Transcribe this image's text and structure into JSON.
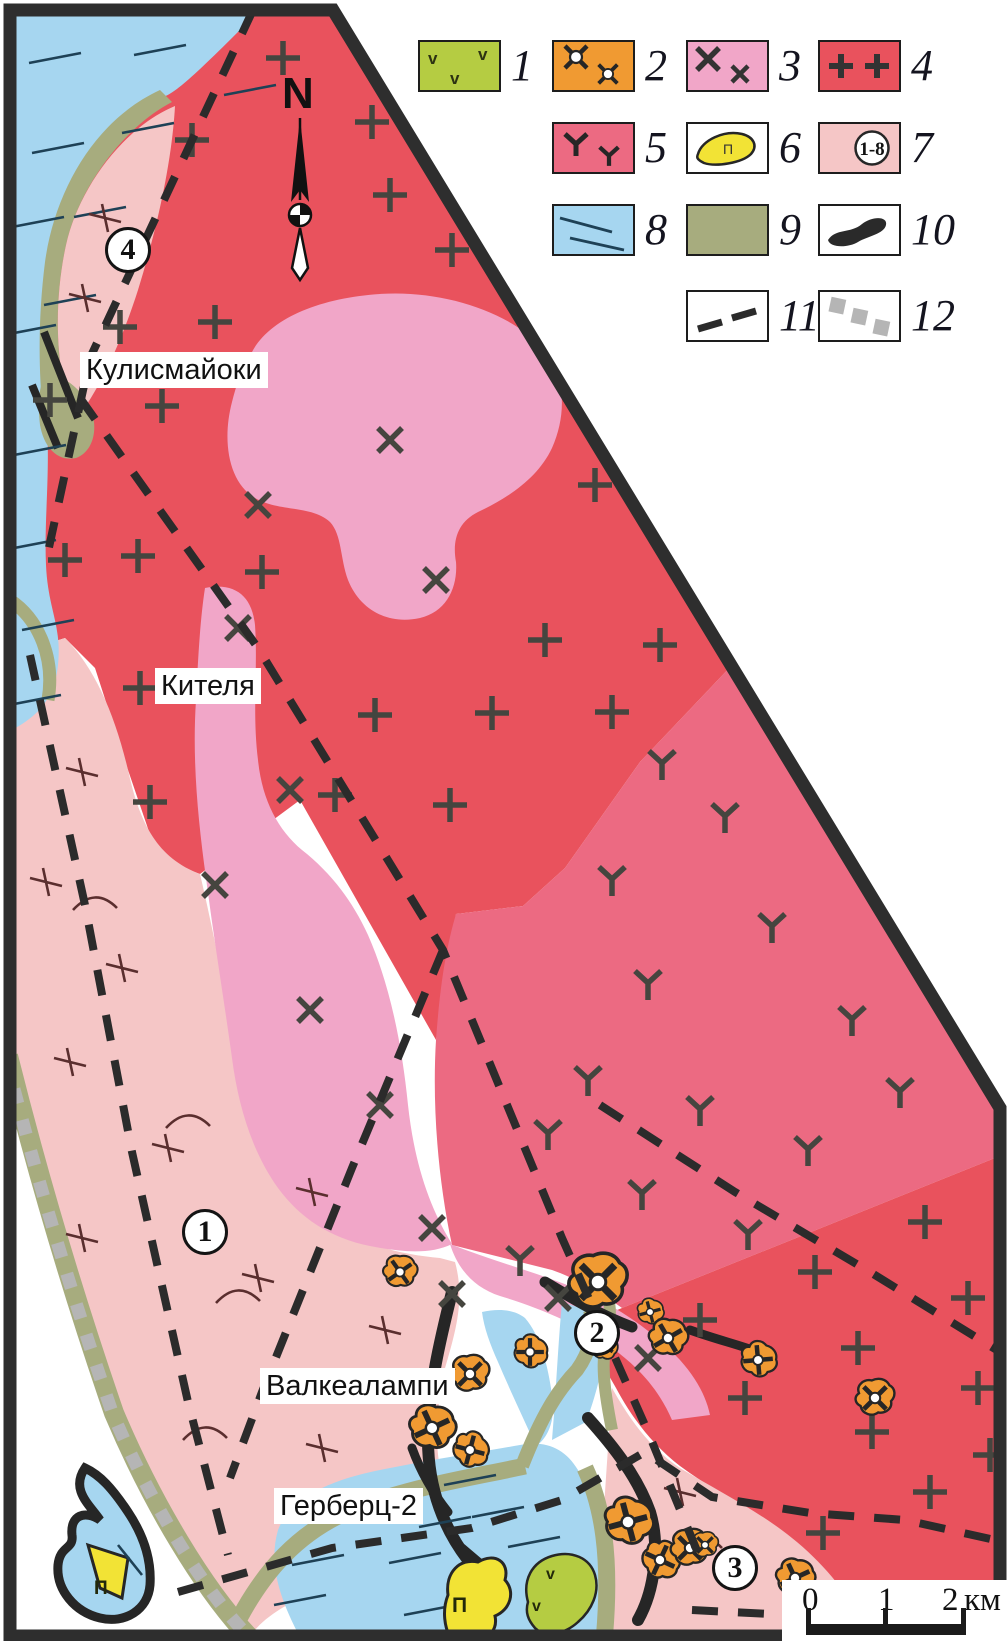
{
  "north": {
    "label": "N"
  },
  "legend": {
    "items": [
      {
        "number": "1",
        "symbol": "v-pattern-green"
      },
      {
        "number": "2",
        "symbol": "ore-flower-orange"
      },
      {
        "number": "3",
        "symbol": "x-pattern-pink"
      },
      {
        "number": "4",
        "symbol": "plus-pattern-red"
      },
      {
        "number": "5",
        "symbol": "y-pattern-rose"
      },
      {
        "number": "6",
        "symbol": "pegmatite-yellow-blob"
      },
      {
        "number": "7",
        "symbol": "numbered-circle-lightpink"
      },
      {
        "number": "8",
        "symbol": "line-pattern-blue"
      },
      {
        "number": "9",
        "symbol": "plain-olive"
      },
      {
        "number": "10",
        "symbol": "black-ribbon"
      },
      {
        "number": "11",
        "symbol": "black-dashed-line"
      },
      {
        "number": "12",
        "symbol": "gray-dotted-line"
      }
    ],
    "glyphs": {
      "v": "v",
      "p": "П",
      "range": "1-8"
    }
  },
  "places": {
    "kulismajoki": "Кулисмайоки",
    "kitelya": "Кителя",
    "valkealampi": "Валкеалампи",
    "gerberts": "Герберц-2"
  },
  "site_markers": {
    "m1": "1",
    "m2": "2",
    "m3": "3",
    "m4": "4"
  },
  "scalebar": {
    "t0": "0",
    "t1": "1",
    "t2": "2",
    "unit": "км"
  },
  "map_glyphs": {
    "p": "П",
    "v": "v"
  },
  "palette": {
    "volcanic_green": "#b5cc42",
    "ore_orange": "#f09a32",
    "pink_x": "#f1a6c8",
    "granite_red": "#e9525d",
    "rose_y": "#ec6a82",
    "pegmatite_yellow": "#f2e335",
    "light_pink": "#f5c6c6",
    "water_blue": "#a6d6f0",
    "olive_green": "#a7ac7e",
    "ink": "#2b2b2b",
    "gray_dots": "#b5b5b5"
  }
}
